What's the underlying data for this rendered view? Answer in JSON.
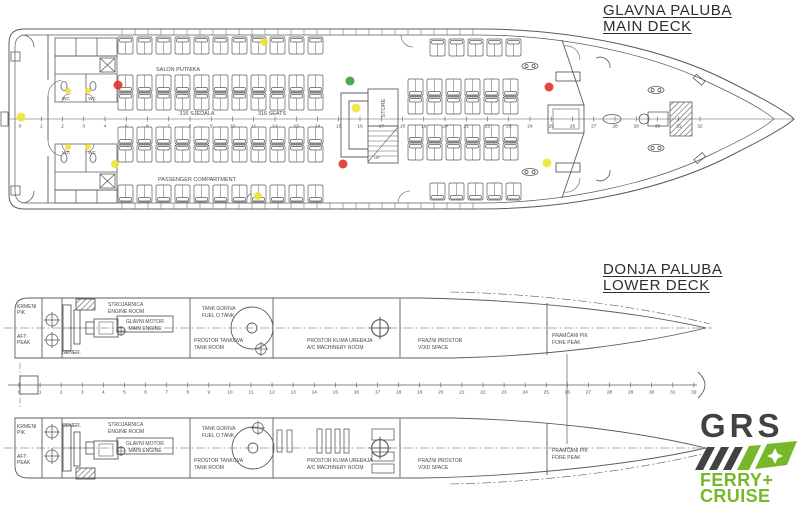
{
  "main_deck": {
    "title_hr": "GLAVNA PALUBA",
    "title_en": "MAIN DECK",
    "labels": {
      "salon": "SALON PUTNIKA",
      "seats_hr": "316 SJEDALA",
      "seats_en": "316 SEATS",
      "compartment": "PASSENGER COMPARTMENT",
      "store": "STORE",
      "up": "UP",
      "wc": "WC"
    },
    "seat_blocks": [
      {
        "x": 118,
        "y": 37,
        "cols": 11,
        "flip": false
      },
      {
        "x": 430,
        "y": 39,
        "cols": 5,
        "flip": false
      },
      {
        "x": 118,
        "y": 75,
        "cols": 11,
        "flip": true
      },
      {
        "x": 118,
        "y": 93,
        "cols": 11,
        "flip": false
      },
      {
        "x": 408,
        "y": 79,
        "cols": 6,
        "flip": true
      },
      {
        "x": 408,
        "y": 97,
        "cols": 6,
        "flip": false
      },
      {
        "x": 118,
        "y": 127,
        "cols": 11,
        "flip": true
      },
      {
        "x": 118,
        "y": 145,
        "cols": 11,
        "flip": false
      },
      {
        "x": 408,
        "y": 125,
        "cols": 6,
        "flip": true
      },
      {
        "x": 408,
        "y": 143,
        "cols": 6,
        "flip": false
      },
      {
        "x": 118,
        "y": 185,
        "cols": 11,
        "flip": true
      },
      {
        "x": 430,
        "y": 183,
        "cols": 5,
        "flip": true
      }
    ],
    "dots": [
      {
        "x": 21,
        "y": 117,
        "r": 4.5,
        "color": "yellow"
      },
      {
        "x": 68,
        "y": 91,
        "r": 3,
        "color": "yellow"
      },
      {
        "x": 88,
        "y": 91,
        "r": 3,
        "color": "yellow"
      },
      {
        "x": 68,
        "y": 147,
        "r": 3,
        "color": "yellow"
      },
      {
        "x": 88,
        "y": 147,
        "r": 3,
        "color": "yellow"
      },
      {
        "x": 115,
        "y": 164,
        "r": 4,
        "color": "yellow"
      },
      {
        "x": 264,
        "y": 42,
        "r": 4,
        "color": "yellow"
      },
      {
        "x": 258,
        "y": 196,
        "r": 4,
        "color": "yellow"
      },
      {
        "x": 356,
        "y": 108,
        "r": 4.5,
        "color": "yellow"
      },
      {
        "x": 547,
        "y": 163,
        "r": 4.5,
        "color": "yellow"
      },
      {
        "x": 118,
        "y": 85,
        "r": 4.5,
        "color": "red"
      },
      {
        "x": 343,
        "y": 164,
        "r": 4.5,
        "color": "red"
      },
      {
        "x": 549,
        "y": 87,
        "r": 4.5,
        "color": "red"
      },
      {
        "x": 350,
        "y": 81,
        "r": 4.5,
        "color": "green"
      }
    ]
  },
  "lower_deck": {
    "title_hr": "DONJA PALUBA",
    "title_en": "LOWER DECK",
    "rooms": {
      "aft_peak_hr1": "KRMENI",
      "aft_peak_hr2": "PIK",
      "aft_peak_en1": "AFT",
      "aft_peak_en2": "PEAK",
      "gener": "GENER.",
      "engine_hr": "STROJARNICA",
      "engine_en": "ENGINE ROOM",
      "main_engine_hr": "GLAVNI MOTOR",
      "main_engine_en": "MAIN ENGINE",
      "fuel_hr": "TANK GORIVA",
      "fuel_en": "FUEL O.TANK",
      "tank_hr": "PROSTOR TANKOVA",
      "tank_en": "TANK ROOM",
      "ac_hr": "PROSTOR KLIMA UREĐAJA",
      "ac_en": "A/C MACHINERY ROOM",
      "void_hr": "PRAZNI PROSTOR",
      "void_en": "VOID SPACE",
      "fore_hr": "PRAMČANI PIK",
      "fore_en": "FORE PEAK"
    }
  },
  "frame_numbers": [
    0,
    1,
    2,
    3,
    4,
    5,
    6,
    7,
    8,
    9,
    10,
    11,
    12,
    13,
    14,
    15,
    16,
    17,
    18,
    19,
    20,
    21,
    22,
    23,
    24,
    25,
    26,
    27,
    28,
    29,
    30,
    31,
    32
  ],
  "logo": {
    "brand": "GRS",
    "line1": "FERRY+",
    "line2": "CRUISE"
  },
  "colors": {
    "line": "#5c5c5c",
    "text": "#4a4a4a",
    "dot_red": "#e2342b",
    "dot_green": "#3c9e3c",
    "dot_yellow": "#f0e23a",
    "logo_green": "#76b82a",
    "logo_dark": "#424242"
  }
}
